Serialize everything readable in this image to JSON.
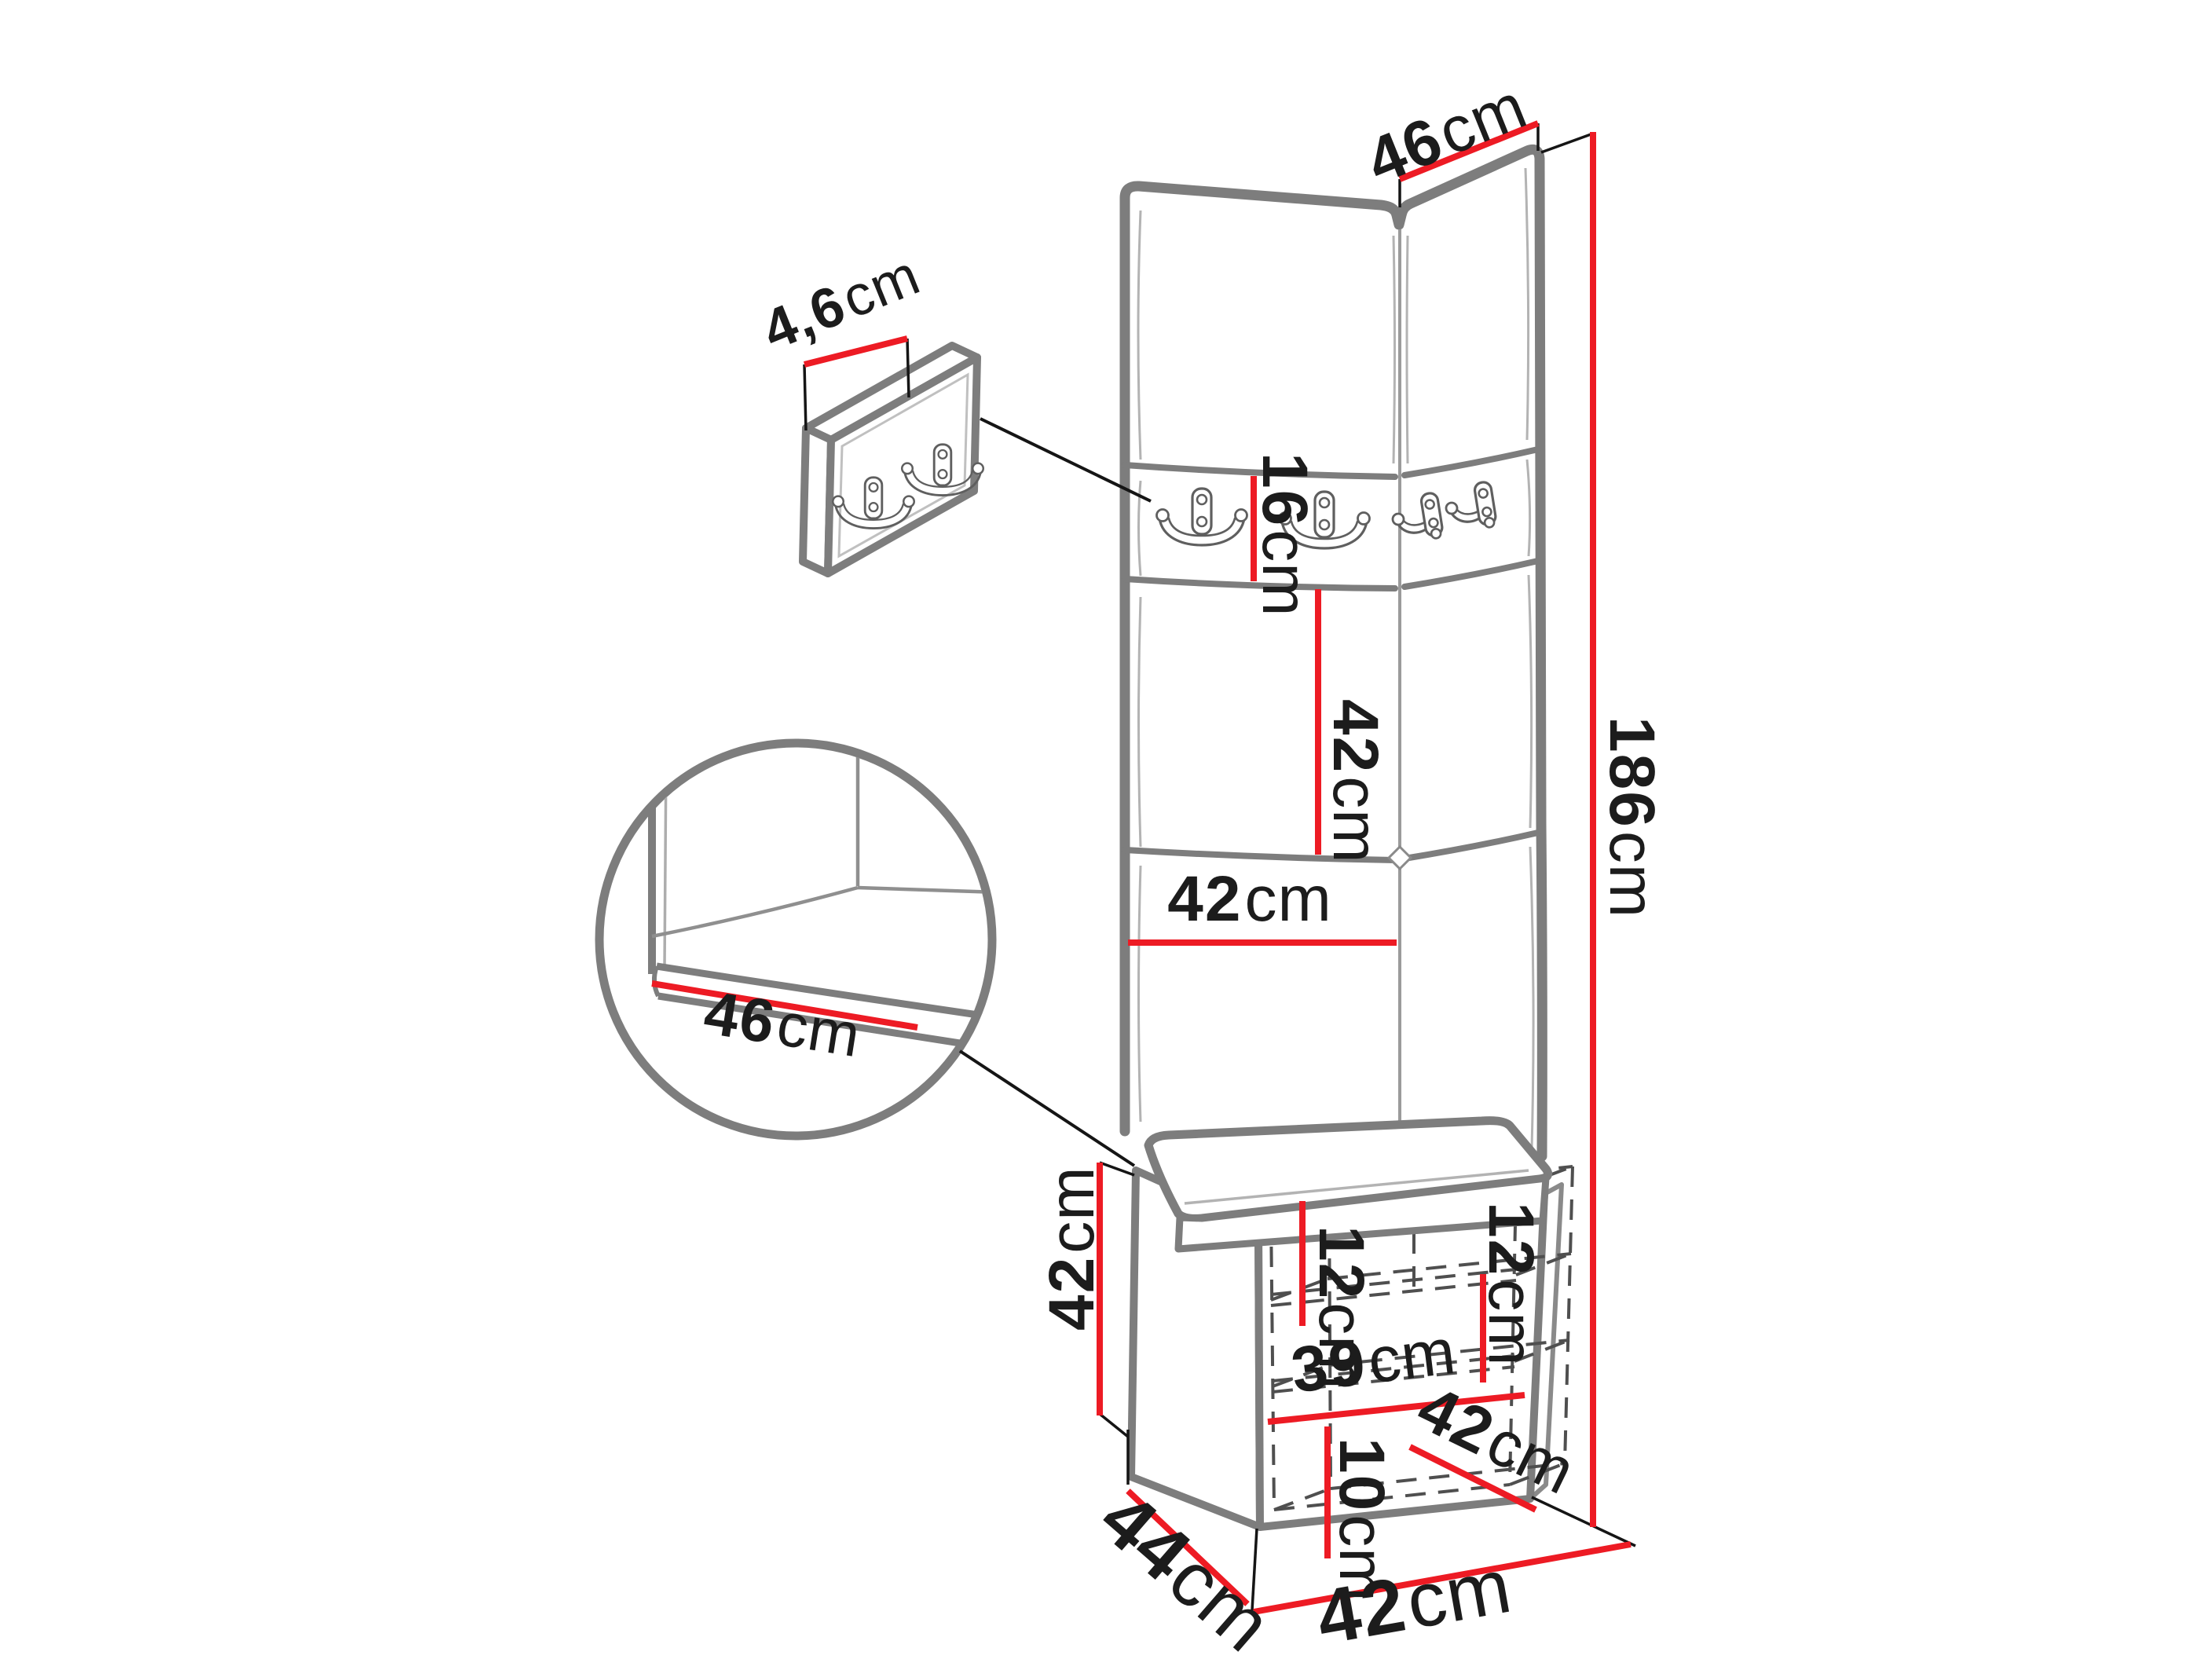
{
  "diagram": {
    "type": "furniture-dimension-drawing",
    "subject": "hallway set: corner upholstered wall panels with coat hooks, wall hook panel, bench cabinet with cushion"
  },
  "colors": {
    "dimension_red": "#ed1b24",
    "outline_gray": "#7d7d7d",
    "detail_gray": "#a8a8a8",
    "dashed_gray": "#4f4f4f",
    "text_black": "#1c1c1c"
  },
  "icons": {
    "hook_front": "double-coat-hook-icon",
    "hook_side": "double-coat-hook-side-icon",
    "detail_circle": "magnifier-detail-circle"
  },
  "labels": {
    "top_width": {
      "num": "46",
      "unit": "cm"
    },
    "panel_thickness": {
      "num": "4,6",
      "unit": "cm"
    },
    "hook_strip_height": {
      "num": "16",
      "unit": "cm"
    },
    "mid_panel_height": {
      "num": "42",
      "unit": "cm"
    },
    "panel_width": {
      "num": "42",
      "unit": "cm"
    },
    "total_height": {
      "num": "186",
      "unit": "cm"
    },
    "seat_depth": {
      "num": "46",
      "unit": "cm"
    },
    "cabinet_height": {
      "num": "42",
      "unit": "cm"
    },
    "top_shelf_height": {
      "num": "12",
      "unit": "cm"
    },
    "door_shelf_height": {
      "num": "12",
      "unit": "cm"
    },
    "interior_width": {
      "num": "39",
      "unit": "cm"
    },
    "plinth_height": {
      "num": "10",
      "unit": "cm"
    },
    "seat_diag_width": {
      "num": "42",
      "unit": "cm"
    },
    "cabinet_depth": {
      "num": "44",
      "unit": "cm"
    },
    "cabinet_width": {
      "num": "42",
      "unit": "cm"
    }
  }
}
